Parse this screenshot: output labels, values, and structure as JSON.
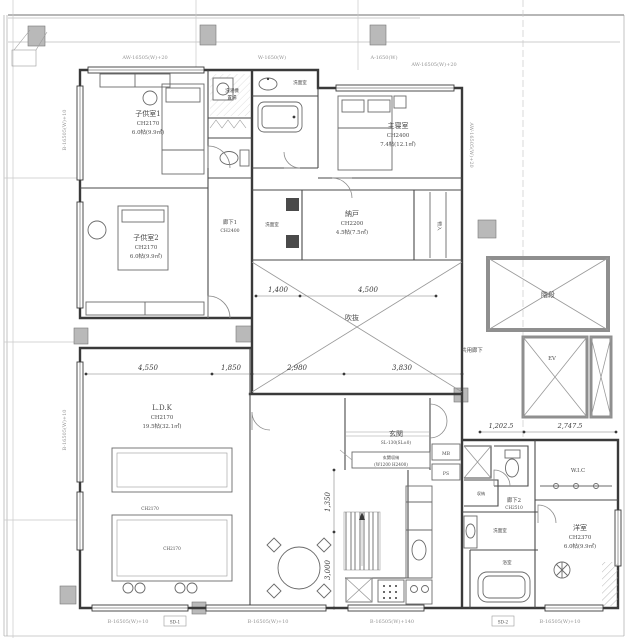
{
  "rooms": {
    "kids1": {
      "name": "子供室1",
      "ch": "CH2170",
      "area": "6.0帖(9.9㎡)"
    },
    "kids2": {
      "name": "子供室2",
      "ch": "CH2170",
      "area": "6.0帖(9.9㎡)"
    },
    "hall1": {
      "name": "廊下1",
      "ch": "CH2400"
    },
    "laundry": {
      "name": "洗濯機",
      "name2": "置場"
    },
    "wash1": {
      "name": "洗面室"
    },
    "master": {
      "name": "主寝室",
      "ch": "CH2400",
      "area": "7.4帖(12.1㎡)"
    },
    "storage_n": {
      "name": "納戸",
      "ch": "CH2200",
      "area": "4.5帖(7.5㎡)"
    },
    "wash_mid": {
      "name": "洗面室"
    },
    "closet_master": {
      "name": "物入"
    },
    "void": {
      "name": "吹抜"
    },
    "ldk": {
      "name": "L.D.K",
      "ch": "CH2170",
      "area": "19.5帖(32.1㎡)"
    },
    "tatami_a": {
      "ch": "CH2170"
    },
    "tatami_b": {
      "ch": "CH2170"
    },
    "entrance": {
      "name": "玄関",
      "level": "SL-130(SL±0)",
      "note1": "玄関収納",
      "note2": "(W1200 H2400)"
    },
    "hall2": {
      "name": "廊下2",
      "ch": "CH2510"
    },
    "storage2": {
      "name": "収納"
    },
    "wic": {
      "name": "W.I.C"
    },
    "west": {
      "name": "洋室",
      "ch": "CH2370",
      "area": "6.0帖(9.9㎡)"
    },
    "wash2": {
      "name": "洗面室"
    },
    "bath2": {
      "name": "浴室"
    },
    "common_corridor": {
      "name": "共用廊下"
    },
    "stairwell": {
      "name": "階段"
    },
    "elevator": {
      "name": "EV"
    },
    "mb": {
      "name": "MB"
    },
    "ps": {
      "name": "PS"
    }
  },
  "dimensions": {
    "void_top_left": "1,400",
    "void_top_right": "4,500",
    "ldk_width": "4,550",
    "ldk_right": "1,850",
    "void_bottom_left": "2,980",
    "void_bottom_right": "3,830",
    "stair_v1": "1,350",
    "stair_v2": "3,000",
    "right_1": "1,202.5",
    "right_2": "2,747.5"
  },
  "window_tags": {
    "top1": "AW-16505(W)+20",
    "top2": "W-1650(W)",
    "top3": "A-1650(W)",
    "top4": "AW-16505(W)+20",
    "bottom1": "B-16505(W)+10",
    "bottom2": "B-16505(W)+10",
    "bottom3": "B-16505(W)+140",
    "bottom4": "B-16505(W)+10",
    "left1": "B-16505(W)+10",
    "left2": "B-16505(W)+10",
    "right1": "AW-16505(W)+20",
    "box1": "SD-1",
    "box2": "SD-2"
  },
  "colors": {
    "line": "#3a3a3a",
    "thin": "#9b9b9b",
    "column": "#b9b9b9",
    "text": "#4a4a4a"
  }
}
